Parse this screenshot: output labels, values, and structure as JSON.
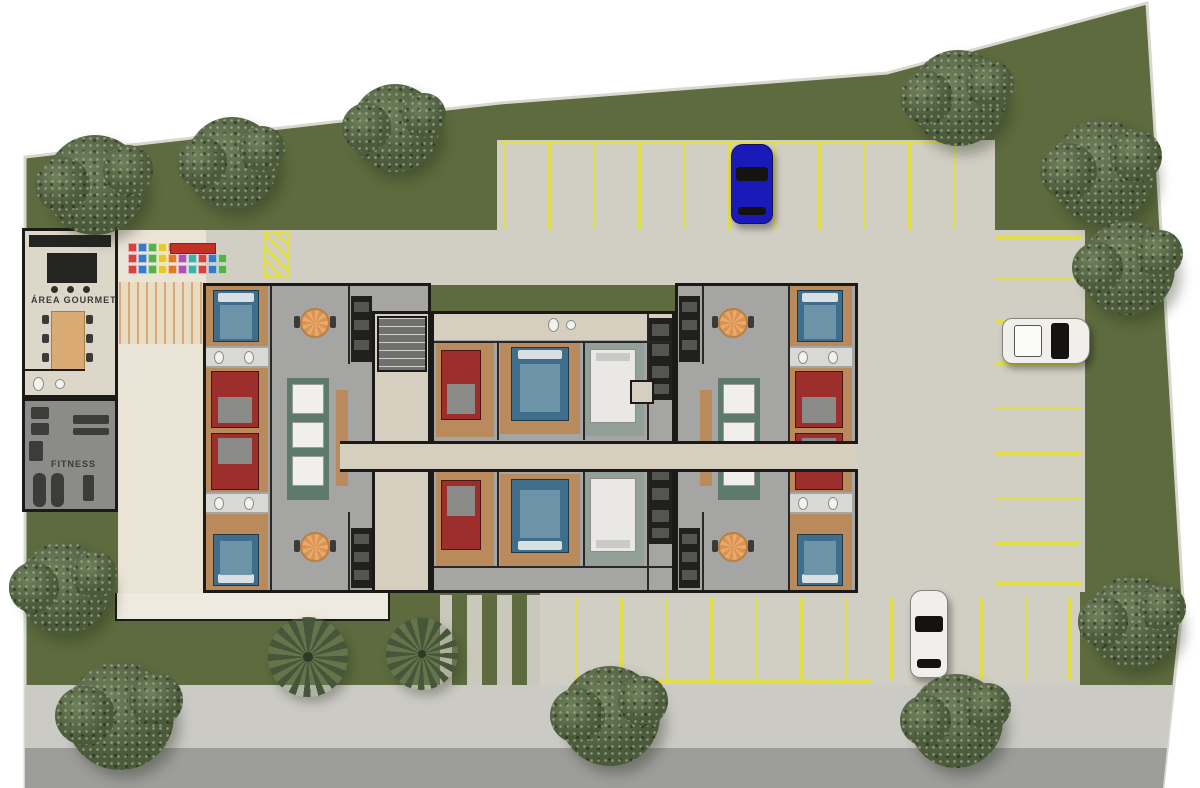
{
  "plan": {
    "type": "residential-site-floorplan",
    "amenities": {
      "gourmet_label": "ÁREA GOURMET",
      "fitness_label": "FITNESS"
    }
  },
  "colors": {
    "lawn": "#5d6b3e",
    "lawn_dark": "#55633a",
    "boundary": "#d9d8d0",
    "asphalt": "#d1cec3",
    "sidewalk": "#cbcac5",
    "road": "#9d9d9b",
    "line_yellow": "#e3df3e",
    "wall": "#1c1a18",
    "floor_gray": "#a5a5a3",
    "floor_beige": "#d9d3c5",
    "patio": "#e9e4d6",
    "courtyard": "#efeae0",
    "wood": "#b98a5b",
    "bed_blue": "#3f6e8c",
    "bed_red": "#9c2e2c",
    "car_blue": "#1a1ab8",
    "car_white": "#f0efeb"
  },
  "site_outline": [
    [
      25,
      157
    ],
    [
      500,
      103
    ],
    [
      887,
      73
    ],
    [
      1147,
      3
    ],
    [
      1158,
      180
    ],
    [
      1183,
      600
    ],
    [
      1163,
      788
    ],
    [
      25,
      788
    ]
  ],
  "ground": {
    "asphalt_rects": [
      [
        497,
        140,
        498,
        90
      ],
      [
        205,
        230,
        653,
        55
      ],
      [
        858,
        230,
        137,
        365
      ],
      [
        995,
        230,
        90,
        362
      ],
      [
        540,
        592,
        540,
        93
      ]
    ],
    "sidewalk": [
      [
        25,
        685
      ],
      [
        1174,
        685
      ],
      [
        1167,
        748
      ],
      [
        25,
        748
      ]
    ],
    "road": [
      [
        25,
        748
      ],
      [
        1167,
        748
      ],
      [
        1163,
        788
      ],
      [
        25,
        788
      ]
    ]
  },
  "parking": {
    "top_lot": {
      "stall_lines_x": [
        503,
        548,
        593,
        638,
        683,
        728,
        773,
        818,
        863,
        908,
        953
      ],
      "y1": 141,
      "y2": 230,
      "header_y": 141,
      "header_x1": 500,
      "header_x2": 958
    },
    "right_lot": {
      "stall_lines_y": [
        236,
        277,
        320,
        362,
        407,
        452,
        497,
        541,
        582
      ],
      "x1": 995,
      "x2": 1082
    },
    "bottom_lot": {
      "stall_lines_x": [
        575,
        620,
        665,
        710,
        755,
        800,
        845,
        890,
        935,
        980,
        1025,
        1068
      ],
      "y1": 597,
      "y2": 680,
      "footer_y": 680,
      "footer_x1": 575,
      "footer_x2": 872,
      "extra_y": 543,
      "extra_x1": 995,
      "extra_x2": 1078
    }
  },
  "trees": [
    {
      "x": 95,
      "y": 185,
      "r": 50
    },
    {
      "x": 232,
      "y": 163,
      "r": 46
    },
    {
      "x": 395,
      "y": 128,
      "r": 44
    },
    {
      "x": 958,
      "y": 98,
      "r": 48
    },
    {
      "x": 1102,
      "y": 172,
      "r": 52
    },
    {
      "x": 1128,
      "y": 268,
      "r": 47
    },
    {
      "x": 1133,
      "y": 622,
      "r": 46
    },
    {
      "x": 64,
      "y": 588,
      "r": 46
    },
    {
      "x": 120,
      "y": 716,
      "r": 54
    },
    {
      "x": 610,
      "y": 716,
      "r": 50
    },
    {
      "x": 956,
      "y": 721,
      "r": 47
    }
  ],
  "palms": [
    {
      "x": 308,
      "y": 657,
      "r": 40
    },
    {
      "x": 422,
      "y": 654,
      "r": 36
    }
  ],
  "cars": [
    {
      "name": "car-blue",
      "color": "#1a1ab8",
      "x": 731,
      "y": 144,
      "w": 42,
      "h": 80,
      "orientation": "vertical"
    },
    {
      "name": "car-white-right",
      "color": "#f0efeb",
      "x": 1002,
      "y": 318,
      "w": 88,
      "h": 46,
      "orientation": "horizontal"
    },
    {
      "name": "car-white-bottom",
      "color": "#f0efeb",
      "x": 910,
      "y": 590,
      "w": 38,
      "h": 88,
      "orientation": "vertical"
    }
  ],
  "playground": {
    "tile_palette": [
      "#d94040",
      "#3a78c8",
      "#58b048",
      "#e8c830",
      "#e07828",
      "#b050b0",
      "#40b0a8"
    ],
    "rows": [
      {
        "x": 128,
        "y": 243,
        "n": 5
      },
      {
        "x": 128,
        "y": 254,
        "n": 10
      },
      {
        "x": 128,
        "y": 265,
        "n": 10
      }
    ],
    "slide_color": "#c23028"
  }
}
